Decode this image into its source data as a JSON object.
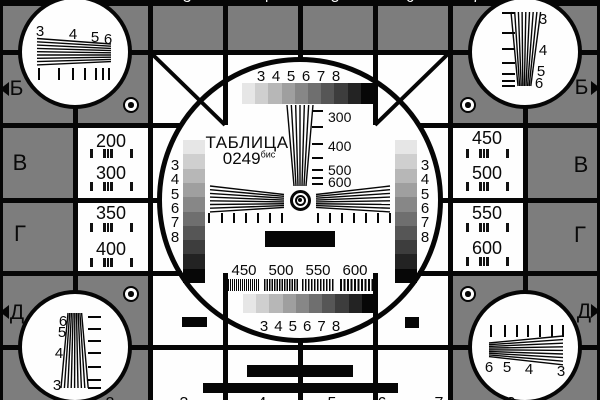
{
  "card_name": "television-test-card",
  "colors": {
    "background_gray": "#7d7d7d",
    "line_black": "#060606",
    "field_white": "#fefefe",
    "grayscale_steps": [
      "#e6e6e6",
      "#cfcfcf",
      "#b7b7b7",
      "#9f9f9f",
      "#878787",
      "#6f6f6f",
      "#565656",
      "#3d3d3d",
      "#232323",
      "#070707"
    ]
  },
  "title": {
    "name": "ТАБЛИЦА",
    "number": "0249",
    "suffix": "бис"
  },
  "edge_letters": {
    "top": "Б",
    "row_upper": "В",
    "row_lower": "Г",
    "bottom": "Д"
  },
  "grayscale_labels": [
    "3",
    "4",
    "5",
    "6",
    "7",
    "8"
  ],
  "vertical_wedge_labels": [
    "300",
    "400",
    "500",
    "600"
  ],
  "burst_row_labels": [
    "450",
    "500",
    "550",
    "600"
  ],
  "side_cells": {
    "left_top": [
      "200",
      "300"
    ],
    "left_bottom": [
      "350",
      "400"
    ],
    "right_top": [
      "450",
      "500"
    ],
    "right_bottom": [
      "550",
      "600"
    ]
  },
  "corner_wedge_labels": {
    "top_left": [
      "3",
      "4",
      "5",
      "6"
    ],
    "top_right": [
      "3",
      "4",
      "5",
      "6"
    ],
    "bottom_left": [
      "6",
      "5",
      "4",
      "3"
    ],
    "bottom_right": [
      "6",
      "5",
      "4",
      "3"
    ]
  },
  "edge_partial_digits": {
    "top": [
      "3",
      "4",
      "5",
      "6",
      "7"
    ],
    "bottom": [
      "2",
      "3",
      "4",
      "5",
      "6",
      "7",
      "8"
    ]
  }
}
